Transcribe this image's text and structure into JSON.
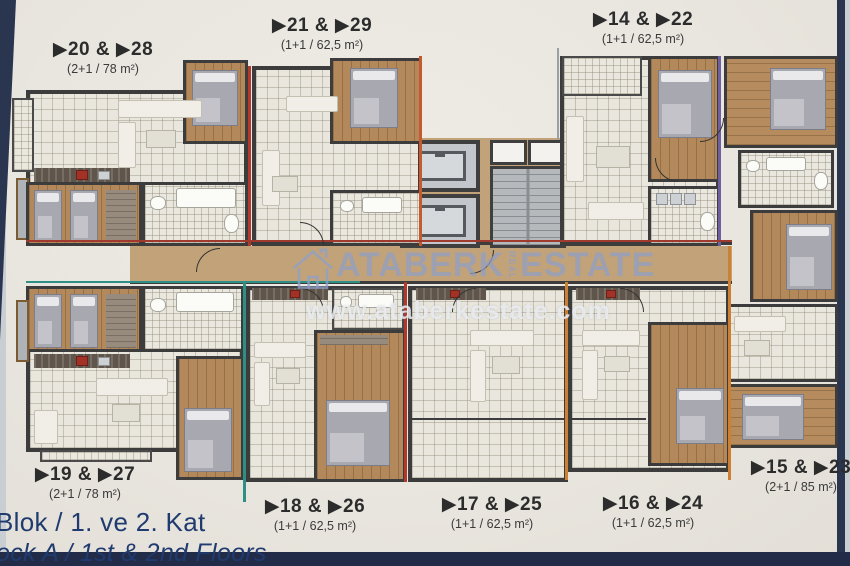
{
  "watermark": {
    "brand": "ATABERK",
    "brand_mid": "REAL",
    "brand2": "ESTATE",
    "url": "www.ataberkestate.com"
  },
  "units": [
    {
      "id": "20-28",
      "label": "▶20 & ▶28",
      "spec": "(2+1 / 78 m²)"
    },
    {
      "id": "21-29",
      "label": "▶21 & ▶29",
      "spec": "(1+1 / 62,5 m²)"
    },
    {
      "id": "14-22",
      "label": "▶14 & ▶22",
      "spec": "(1+1 / 62,5 m²)"
    },
    {
      "id": "19-27",
      "label": "▶19 & ▶27",
      "spec": "(2+1 / 78 m²)"
    },
    {
      "id": "18-26",
      "label": "▶18 & ▶26",
      "spec": "(1+1 / 62,5 m²)"
    },
    {
      "id": "17-25",
      "label": "▶17 & ▶25",
      "spec": "(1+1 / 62,5 m²)"
    },
    {
      "id": "16-24",
      "label": "▶16 & ▶24",
      "spec": "(1+1 / 62,5 m²)"
    },
    {
      "id": "15-23",
      "label": "▶15 & ▶23",
      "spec": "(2+1 / 85 m²)"
    }
  ],
  "footer": {
    "line1": "Blok / 1. ve 2. Kat",
    "line2": "ock A / 1st & 2nd Floors"
  },
  "colors": {
    "divider_red": "#b0392c",
    "divider_teal": "#2e8f84",
    "divider_orange": "#cd7f32",
    "divider_purple": "#6f5fa0",
    "corridor_tan": "#c2a278",
    "wall": "#3c3c3c",
    "footer_navy": "#1f3b6f",
    "sheet": "#eae6df",
    "border_navy": "#2a3550"
  }
}
